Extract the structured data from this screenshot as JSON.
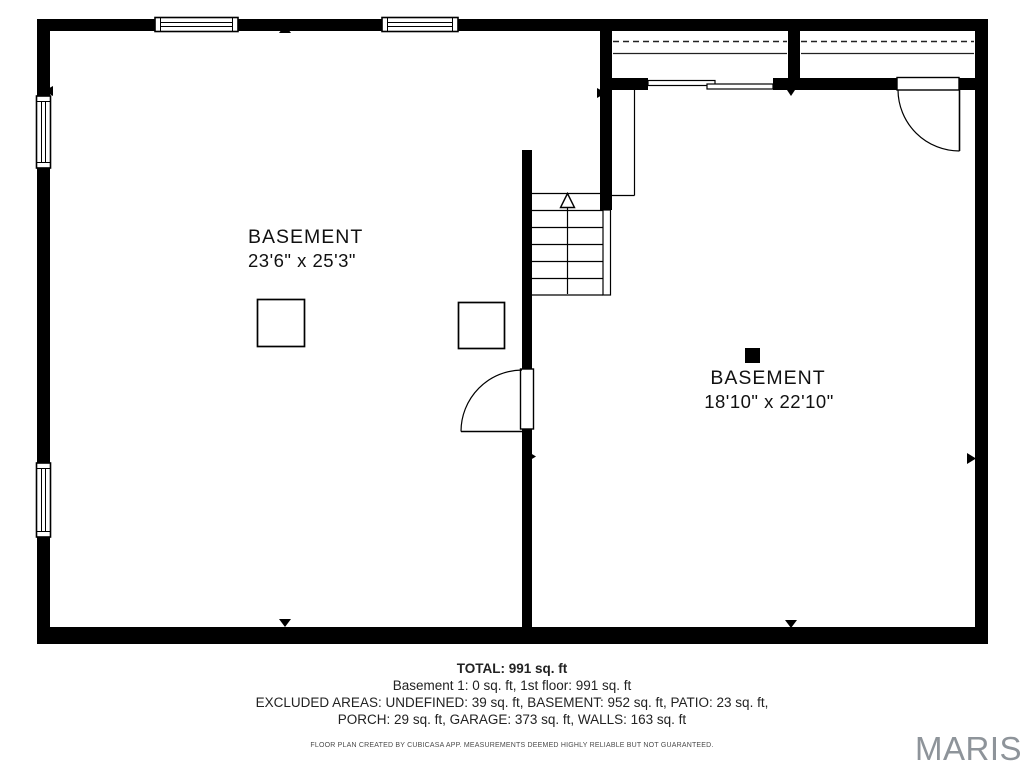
{
  "rooms": [
    {
      "name": "BASEMENT",
      "dimensions": "23'6\" x 25'3\""
    },
    {
      "name": "BASEMENT",
      "dimensions": "18'10\" x 22'10\""
    }
  ],
  "summary": {
    "total": "TOTAL: 991 sq. ft",
    "floors": "Basement 1: 0 sq. ft, 1st floor: 991 sq. ft",
    "excluded_line_1": "EXCLUDED AREAS: UNDEFINED: 39 sq. ft, BASEMENT: 952 sq. ft, PATIO: 23 sq. ft,",
    "excluded_line_2": "PORCH: 29 sq. ft, GARAGE: 373 sq. ft, WALLS: 163 sq. ft",
    "disclaimer": "FLOOR PLAN CREATED BY CUBICASA APP. MEASUREMENTS DEEMED HIGHLY RELIABLE BUT NOT GUARANTEED."
  },
  "watermark": "MARIS",
  "colors": {
    "wall": "#000000",
    "background": "#ffffff",
    "text": "#111111",
    "summary_text": "#222222",
    "watermark": "#8e949a"
  }
}
